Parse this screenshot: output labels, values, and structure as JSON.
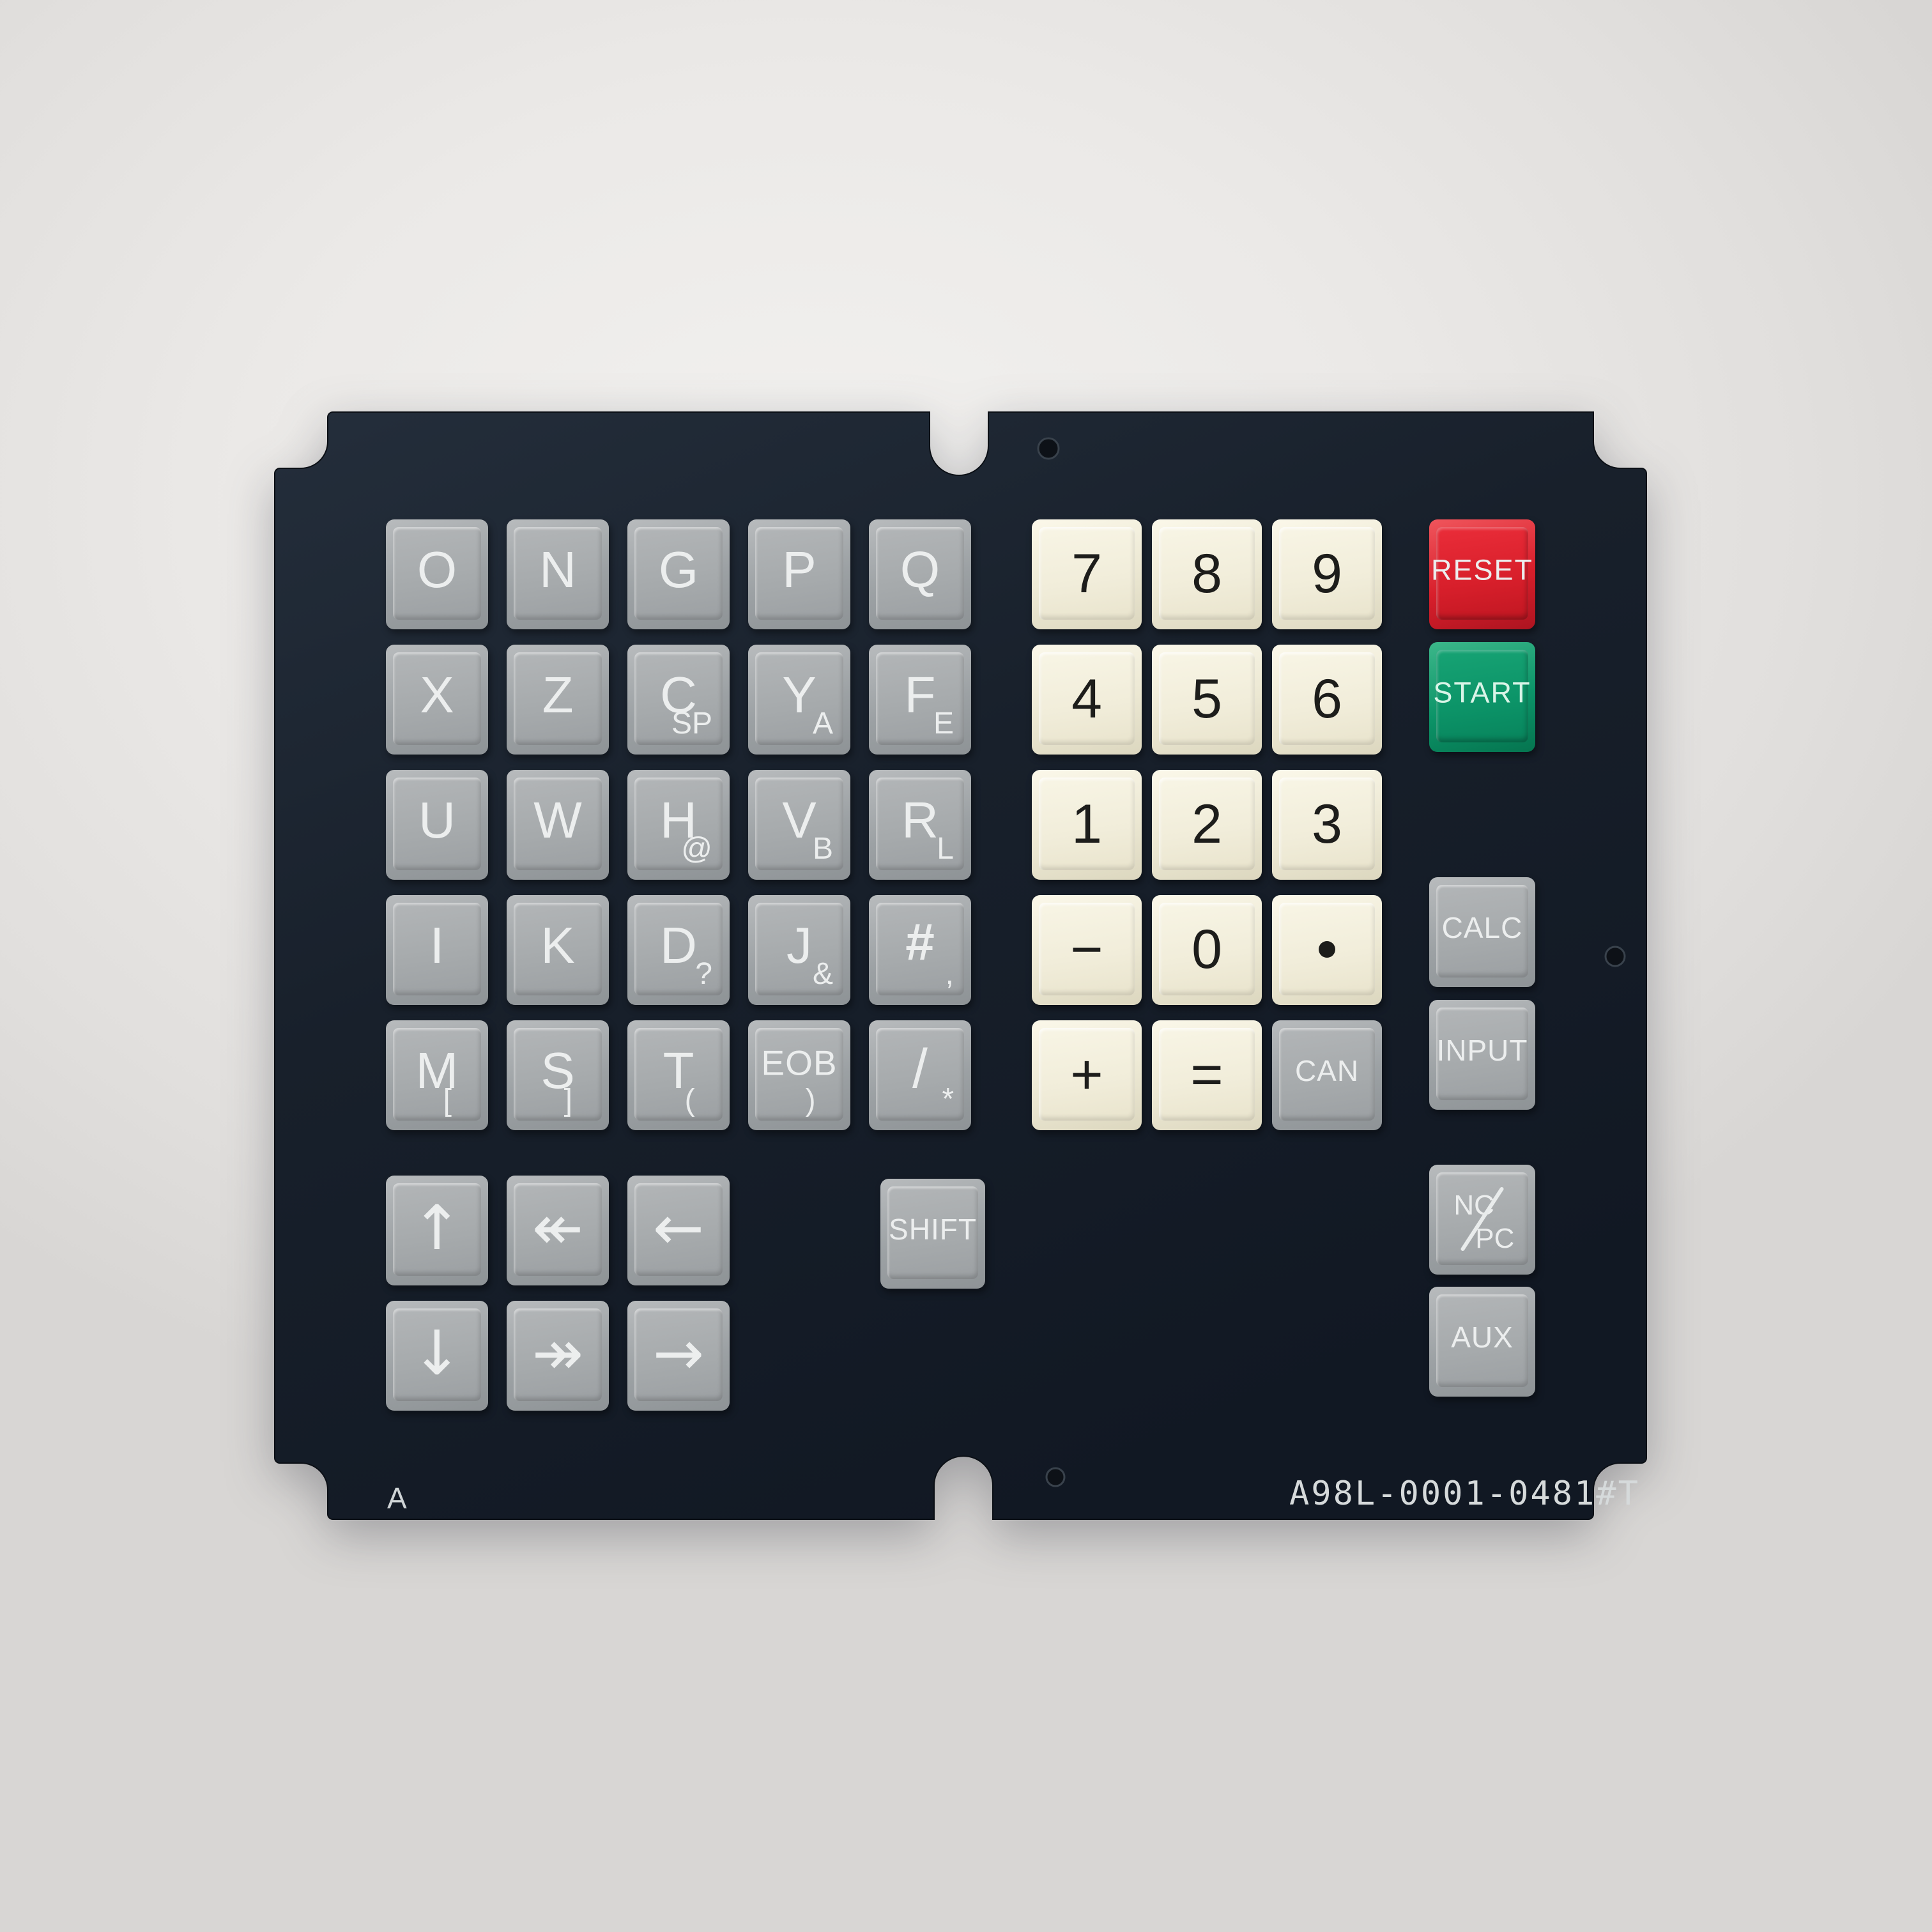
{
  "device": {
    "part_number": "A98L-0001-0481#T",
    "revision": "A"
  },
  "colors": {
    "background": "#e9e7e4",
    "panel_dark": "#19212c",
    "key_gray": "#a5a9ab",
    "key_ivory": "#f2eedb",
    "reset_red": "#d81f2b",
    "start_green": "#0c9468",
    "text_light": "#eceeee",
    "text_dark": "#1d1d1b"
  },
  "letter_keys": [
    {
      "name": "key-o",
      "label": "O",
      "row": 0,
      "col": 0
    },
    {
      "name": "key-n",
      "label": "N",
      "row": 0,
      "col": 1
    },
    {
      "name": "key-g",
      "label": "G",
      "row": 0,
      "col": 2
    },
    {
      "name": "key-p",
      "label": "P",
      "row": 0,
      "col": 3
    },
    {
      "name": "key-q",
      "label": "Q",
      "row": 0,
      "col": 4
    },
    {
      "name": "key-x",
      "label": "X",
      "row": 1,
      "col": 0
    },
    {
      "name": "key-z",
      "label": "Z",
      "row": 1,
      "col": 1
    },
    {
      "name": "key-c",
      "label": "C",
      "sub": "SP",
      "row": 1,
      "col": 2
    },
    {
      "name": "key-y",
      "label": "Y",
      "sub": "A",
      "row": 1,
      "col": 3
    },
    {
      "name": "key-f",
      "label": "F",
      "sub": "E",
      "row": 1,
      "col": 4
    },
    {
      "name": "key-u",
      "label": "U",
      "row": 2,
      "col": 0
    },
    {
      "name": "key-w",
      "label": "W",
      "row": 2,
      "col": 1
    },
    {
      "name": "key-h",
      "label": "H",
      "sub": "@",
      "row": 2,
      "col": 2
    },
    {
      "name": "key-v",
      "label": "V",
      "sub": "B",
      "row": 2,
      "col": 3
    },
    {
      "name": "key-r",
      "label": "R",
      "sub": "L",
      "row": 2,
      "col": 4
    },
    {
      "name": "key-i",
      "label": "I",
      "row": 3,
      "col": 0
    },
    {
      "name": "key-k",
      "label": "K",
      "row": 3,
      "col": 1
    },
    {
      "name": "key-d",
      "label": "D",
      "sub": "?",
      "row": 3,
      "col": 2
    },
    {
      "name": "key-j",
      "label": "J",
      "sub": "&",
      "row": 3,
      "col": 3
    },
    {
      "name": "key-hash",
      "label": "#",
      "sub": ",",
      "row": 3,
      "col": 4,
      "cls": "f-hash"
    },
    {
      "name": "key-m",
      "label": "M",
      "sub": "[",
      "near": true,
      "row": 4,
      "col": 0
    },
    {
      "name": "key-s",
      "label": "S",
      "sub": "]",
      "near": true,
      "row": 4,
      "col": 1
    },
    {
      "name": "key-t",
      "label": "T",
      "sub": "(",
      "near": true,
      "row": 4,
      "col": 2
    },
    {
      "name": "key-eob",
      "label": "EOB",
      "sub": ")",
      "near": true,
      "row": 4,
      "col": 3,
      "cls": "f-eob"
    },
    {
      "name": "key-slash",
      "label": "/",
      "sub": "*",
      "row": 4,
      "col": 4,
      "cls": "f-slashkey"
    }
  ],
  "numpad_keys": [
    {
      "name": "key-7",
      "label": "7",
      "row": 0,
      "col": 0
    },
    {
      "name": "key-8",
      "label": "8",
      "row": 0,
      "col": 1
    },
    {
      "name": "key-9",
      "label": "9",
      "row": 0,
      "col": 2
    },
    {
      "name": "key-4",
      "label": "4",
      "row": 1,
      "col": 0
    },
    {
      "name": "key-5",
      "label": "5",
      "row": 1,
      "col": 1
    },
    {
      "name": "key-6",
      "label": "6",
      "row": 1,
      "col": 2
    },
    {
      "name": "key-1",
      "label": "1",
      "row": 2,
      "col": 0
    },
    {
      "name": "key-2",
      "label": "2",
      "row": 2,
      "col": 1
    },
    {
      "name": "key-3",
      "label": "3",
      "row": 2,
      "col": 2
    },
    {
      "name": "key-minus",
      "label": "−",
      "row": 3,
      "col": 0,
      "cls": "f-op"
    },
    {
      "name": "key-0",
      "label": "0",
      "row": 3,
      "col": 1
    },
    {
      "name": "key-decimal-point",
      "label": "·",
      "row": 3,
      "col": 2,
      "type": "dot"
    },
    {
      "name": "key-plus",
      "label": "+",
      "row": 4,
      "col": 0,
      "cls": "f-op"
    },
    {
      "name": "key-equals",
      "label": "=",
      "row": 4,
      "col": 1,
      "cls": "f-op"
    },
    {
      "name": "key-can",
      "label": "CAN",
      "row": 4,
      "col": 2,
      "variant": "gray",
      "cls": "f-word"
    }
  ],
  "side_keys": [
    {
      "name": "key-reset",
      "label": "RESET",
      "variant": "red",
      "slot": 0
    },
    {
      "name": "key-start",
      "label": "START",
      "variant": "green",
      "slot": 1
    },
    {
      "name": "key-calc",
      "label": "CALC",
      "variant": "gray",
      "slot": 2,
      "cls": "f-word"
    },
    {
      "name": "key-input",
      "label": "INPUT",
      "variant": "gray",
      "slot": 3,
      "cls": "f-word"
    },
    {
      "name": "key-nc-pc",
      "label": "NC/PC",
      "variant": "gray",
      "slot": 4,
      "type": "ncpc",
      "part_top": "NC",
      "part_bottom": "PC"
    },
    {
      "name": "key-aux",
      "label": "AUX",
      "variant": "gray",
      "slot": 5,
      "cls": "f-word"
    }
  ],
  "arrow_keys": [
    {
      "name": "key-arrow-up",
      "glyph": "↑",
      "row": 0,
      "col": 0
    },
    {
      "name": "key-arrow-left-double",
      "glyph": "↞",
      "row": 0,
      "col": 1
    },
    {
      "name": "key-arrow-left",
      "glyph": "←",
      "row": 0,
      "col": 2
    },
    {
      "name": "key-arrow-down",
      "glyph": "↓",
      "row": 1,
      "col": 0
    },
    {
      "name": "key-arrow-right-double",
      "glyph": "↠",
      "row": 1,
      "col": 1
    },
    {
      "name": "key-arrow-right",
      "glyph": "→",
      "row": 1,
      "col": 2
    }
  ],
  "shift_key": {
    "name": "key-shift",
    "label": "SHIFT",
    "cls": "f-word"
  }
}
